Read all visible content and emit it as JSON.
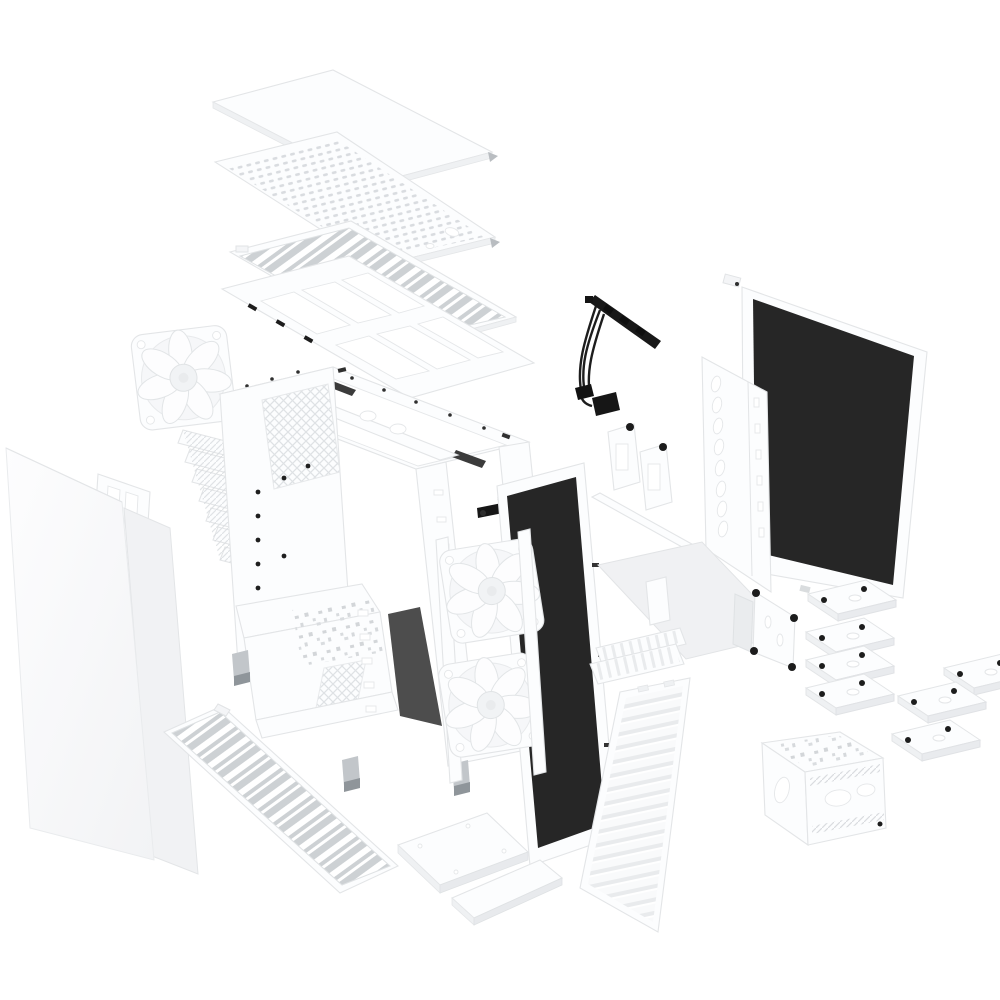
{
  "scene": {
    "description": "Exploded view product render of a white ATX mid-tower PC case: top cover, perforated vent panel, top dust filter and radiator bracket lifted above the chassis; rear exhaust fan, PCI slot covers and side panels to the left; two front fans, black front dust filter, slatted front panel and cable harness in the middle; sound-damped side panel, drive brackets, HDD trays and HDD cage to the right; diagonal-slat bottom dust filter and accessory plates below.",
    "background": "#ffffff"
  },
  "colors": {
    "background": "#ffffff",
    "panel_white": "#fcfdfe",
    "outline_gray": "#e3e5e7",
    "shade_gray": "#eff1f3",
    "filter_mesh_gray": "#cdd1d4",
    "mesh_black": "#262626",
    "cable_black": "#1d1d1d",
    "screw_black": "#1c1c1c",
    "foot_gray": "#c2c6ca"
  },
  "parts": {
    "top_stack": [
      "top-cover-panel",
      "top-mesh-panel",
      "top-dust-filter",
      "top-radiator-bracket"
    ],
    "left_side": [
      "rear-exhaust-fan",
      "pci-slot-covers",
      "expansion-bracket",
      "side-panel-left",
      "side-panel-back"
    ],
    "center": [
      "chassis-frame",
      "psu-shroud",
      "case-feet",
      "side-panel-latch",
      "front-fan-top",
      "front-fan-bottom",
      "front-dust-filter",
      "front-io-cable-harness"
    ],
    "front": [
      "front-panel",
      "front-top-vent-insert",
      "top-trim-strip",
      "cable-cover-plate",
      "bottom-dust-filter",
      "accessory-plate-large",
      "accessory-plate-strip",
      "ssd-bracket-1",
      "ssd-bracket-2"
    ],
    "right_side": [
      "side-panel-right-sound-damped",
      "drive-mount-bracket",
      "pump-bracket-plate",
      "spacer-plate",
      "hdd-tray-stack",
      "hdd-cage"
    ]
  }
}
